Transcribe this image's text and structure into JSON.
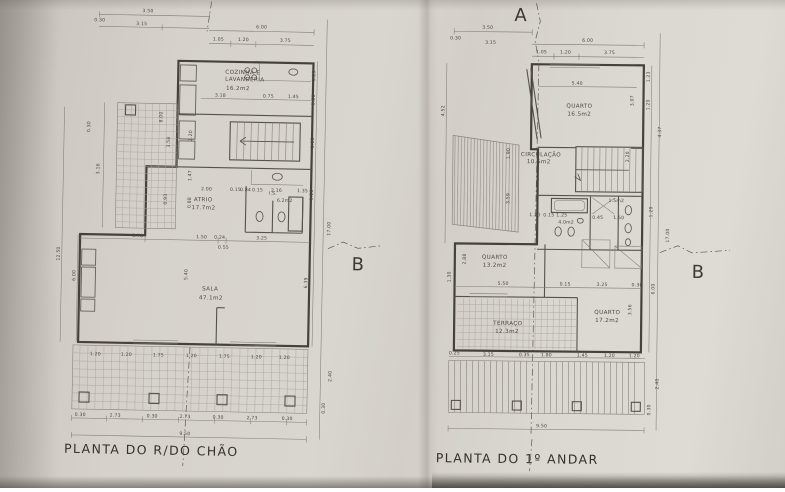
{
  "sheet": {
    "captions": {
      "ground": "PLANTA DO R/DO CHÃO",
      "first": "PLANTA DO 1º ANDAR"
    },
    "markers": {
      "a": "A",
      "b": "B"
    }
  },
  "ground": {
    "rooms": {
      "kitchen": {
        "l1": "COZINHA E",
        "l2": "LAVANDERIA",
        "area": "16.2m2"
      },
      "atrio": {
        "name": "ATRIO",
        "area": "17.7m2"
      },
      "wc": {
        "name": "I.S.",
        "area": "6.2m2"
      },
      "sala": {
        "name": "SALA",
        "area": "47.1m2"
      }
    },
    "dims": {
      "t1": "3.50",
      "t1a": "0.30",
      "t1b": "3.15",
      "t2": "6.00",
      "t3": [
        "1.05",
        "1.20",
        "3.75"
      ],
      "kit": [
        "3.18",
        "0.75",
        "1.45"
      ],
      "wc": [
        "2.00",
        "0.15",
        "0.84",
        "0.15",
        "2.16",
        "1.35"
      ],
      "atv": [
        "2.20",
        "1.47",
        "0.88"
      ],
      "mid": [
        "3.78",
        "1.50",
        "0.24",
        "3.25",
        "0.55"
      ],
      "salav": "5.40",
      "leftv": [
        "0.30",
        "3.16",
        "8.00",
        "3.58",
        "0.93",
        "12.50",
        "6.00"
      ],
      "rightv": [
        "1.23",
        "1.20",
        "3.66",
        "1.20",
        "17.00",
        "6.39",
        "2.40",
        "0.30"
      ],
      "b1": [
        "1.20",
        "1.20",
        "1.75",
        "1.20",
        "1.75",
        "1.20",
        "1.20"
      ],
      "b2": [
        "0.30",
        "2.73",
        "0.30",
        "2.73",
        "0.30",
        "2.73",
        "0.30"
      ],
      "total": "9.50"
    }
  },
  "first": {
    "rooms": {
      "q1": {
        "name": "QUARTO",
        "area": "16.5m2"
      },
      "circ": {
        "name": "CIRCULAÇÃO",
        "area": "10.5m2"
      },
      "wc1": {
        "area": "4.0m2"
      },
      "wc2": {
        "area": "1.5m2"
      },
      "q2": {
        "name": "QUARTO",
        "area": "13.2m2"
      },
      "terraco": {
        "name": "TERRAÇO",
        "area": "12.3m2"
      },
      "q3": {
        "name": "QUARTO",
        "area": "17.2m2"
      }
    },
    "dims": {
      "t1": "3.50",
      "t1a": "0.30",
      "t1b": "3.15",
      "t2": "6.00",
      "t3": [
        "1.05",
        "1.20",
        "3.75"
      ],
      "inner": "5.40",
      "wc": [
        "1.20",
        "0.15",
        "1.25",
        "0.45",
        "1.50"
      ],
      "mid": [
        "5.50",
        "0.15",
        "3.25",
        "0.30"
      ],
      "leftv": [
        "4.52",
        "1.90",
        "3.59",
        "2.88",
        "1.30"
      ],
      "rightv": [
        "1.23",
        "1.20",
        "3.07",
        "2.20",
        "4.37",
        "1.20",
        "17.00",
        "6.00",
        "3.56",
        "2.40",
        "0.30"
      ],
      "b1": [
        "0.25",
        "3.15",
        "0.35",
        "1.80",
        "1.45",
        "1.20",
        "1.20"
      ],
      "total": "9.50"
    }
  }
}
